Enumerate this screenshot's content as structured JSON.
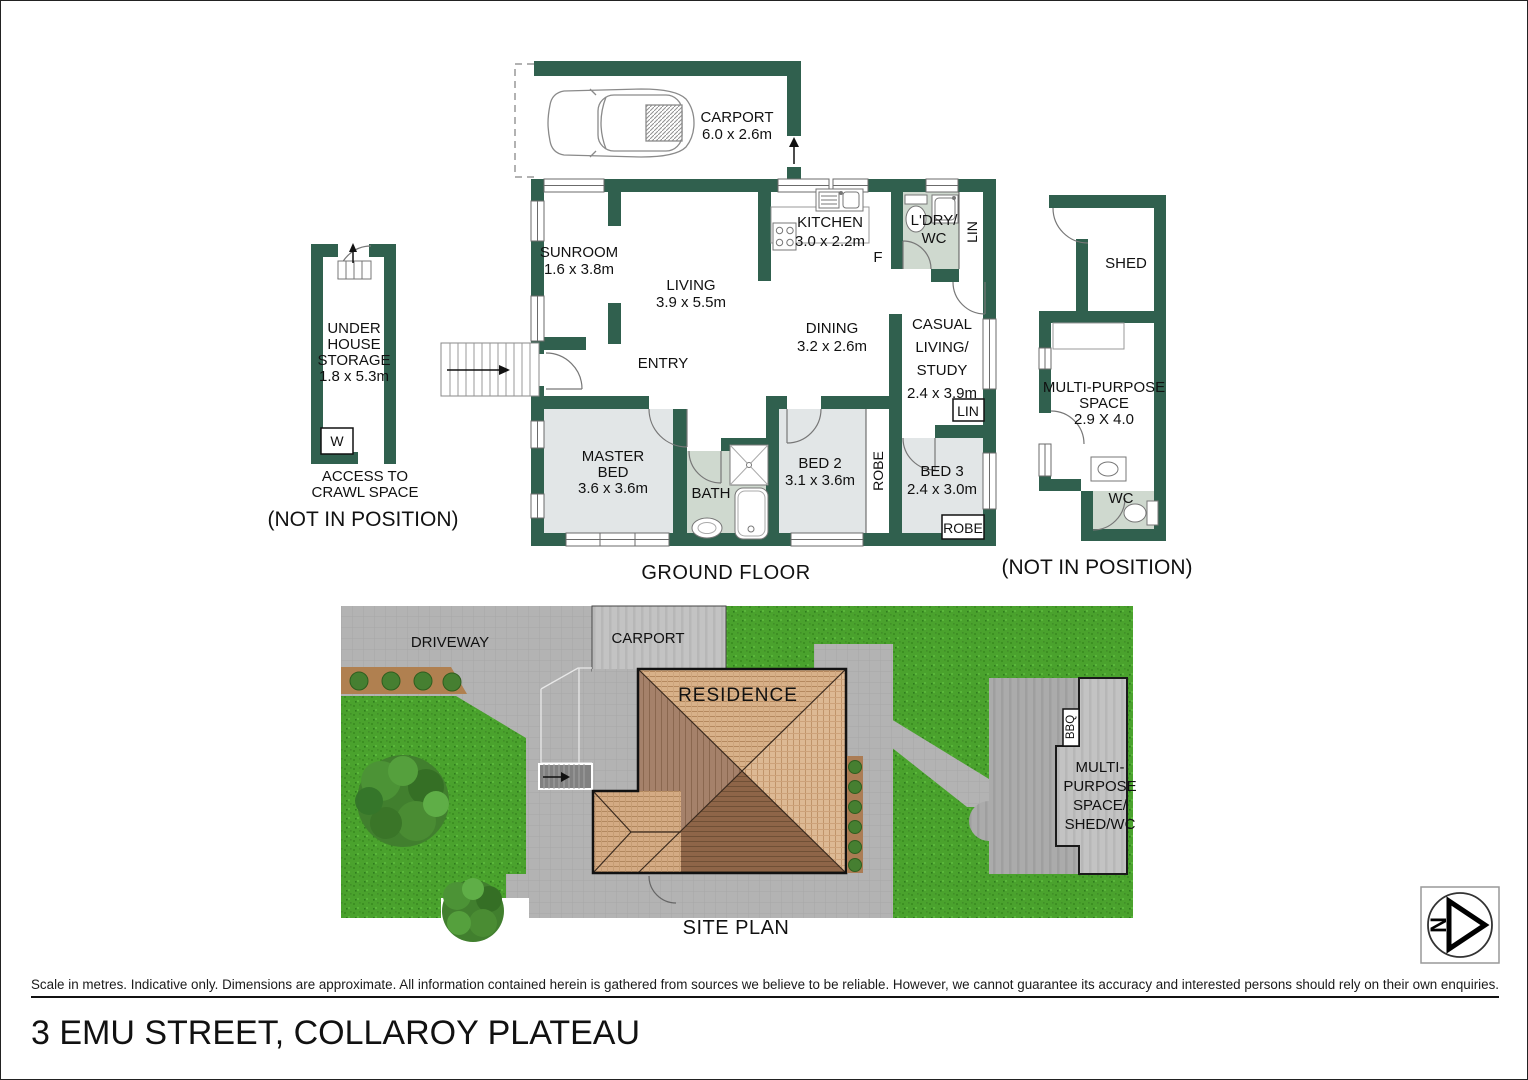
{
  "colors": {
    "wall": "#30604e",
    "wet_area": "#cfd9cf",
    "bedroom": "#e2e6e7",
    "grass": "#4aa22d",
    "paving": "#b3b3b3",
    "roof_light": "#d8b189",
    "roof_dark": "#8e6548",
    "line": "#666666"
  },
  "fp": {
    "carport": {
      "name": "CARPORT",
      "dims": "6.0 x 2.6m"
    },
    "sunroom": {
      "name": "SUNROOM",
      "dims": "1.6 x 3.8m"
    },
    "living": {
      "name": "LIVING",
      "dims": "3.9 x 5.5m"
    },
    "kitchen": {
      "name": "KITCHEN",
      "dims": "3.0 x 2.2m"
    },
    "laundry": {
      "l1": "L'DRY/",
      "l2": "WC"
    },
    "lin": "LIN",
    "fridge": "F",
    "dining": {
      "name": "DINING",
      "dims": "3.2 x 2.6m"
    },
    "casual": {
      "l1": "CASUAL",
      "l2": "LIVING/",
      "l3": "STUDY",
      "dims": "2.4 x 3.9m"
    },
    "entry": "ENTRY",
    "master": {
      "l1": "MASTER",
      "l2": "BED",
      "dims": "3.6 x 3.6m"
    },
    "bath": "BATH",
    "bed2": {
      "name": "BED 2",
      "dims": "3.1 x 3.6m"
    },
    "robe": "ROBE",
    "bed3": {
      "name": "BED 3",
      "dims": "2.4 x 3.0m"
    },
    "lin_box": "LIN",
    "robe_box": "ROBE",
    "title": "GROUND FLOOR"
  },
  "storage": {
    "l1": "UNDER",
    "l2": "HOUSE",
    "l3": "STORAGE",
    "dims": "1.8 x 5.3m",
    "w": "W",
    "a1": "ACCESS TO",
    "a2": "CRAWL SPACE",
    "note": "(NOT IN POSITION)"
  },
  "outbuilding": {
    "shed": "SHED",
    "mp1": "MULTI-PURPOSE",
    "mp2": "SPACE",
    "dims": "2.9 X 4.0",
    "wc": "WC",
    "note": "(NOT IN POSITION)"
  },
  "site": {
    "driveway": "DRIVEWAY",
    "carport": "CARPORT",
    "residence": "RESIDENCE",
    "bbq": "BBQ",
    "mp1": "MULTI-",
    "mp2": "PURPOSE",
    "mp3": "SPACE/",
    "mp4": "SHED/WC",
    "title": "SITE PLAN"
  },
  "compass": {
    "n": "N"
  },
  "footer": {
    "disclaimer": "Scale in metres. Indicative only. Dimensions are approximate. All information contained herein is gathered from sources we believe to be reliable. However, we cannot guarantee its accuracy and interested persons should rely on their own enquiries.",
    "address": "3 EMU STREET, COLLAROY PLATEAU"
  }
}
